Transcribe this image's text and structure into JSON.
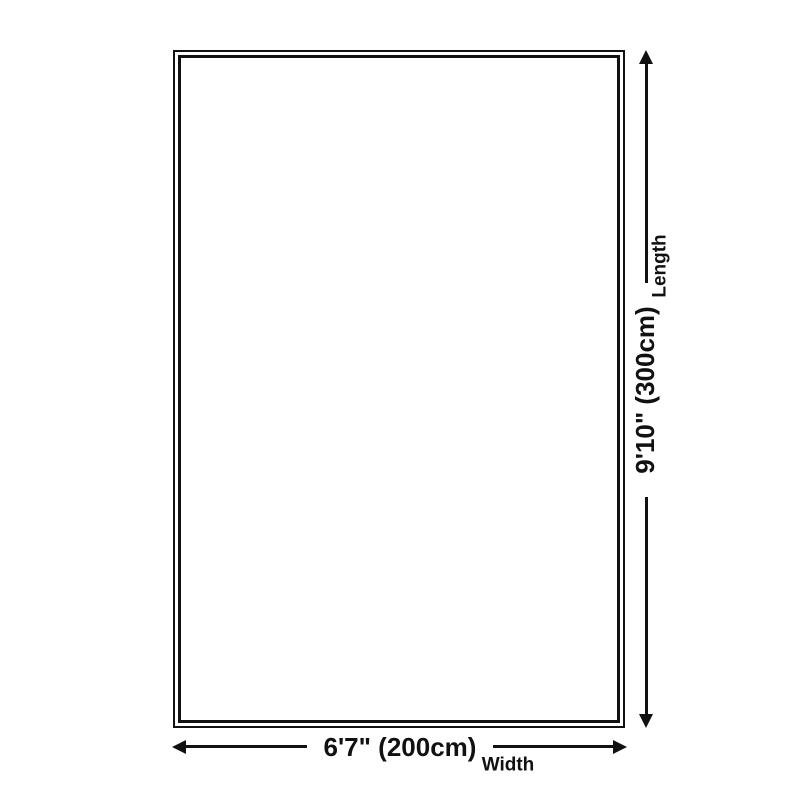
{
  "diagram": {
    "type": "product-size-diagram",
    "dimensions": {
      "width": {
        "value": "6'7\" (200cm)",
        "label": "Width"
      },
      "length": {
        "value": "9'10\" (300cm)",
        "label": "Length"
      }
    },
    "icons": [
      "arrow-up-icon",
      "arrow-down-icon",
      "arrow-left-icon",
      "arrow-right-icon"
    ],
    "colors": {
      "line": "#111111",
      "text": "#111111",
      "background": "#ffffff"
    }
  }
}
